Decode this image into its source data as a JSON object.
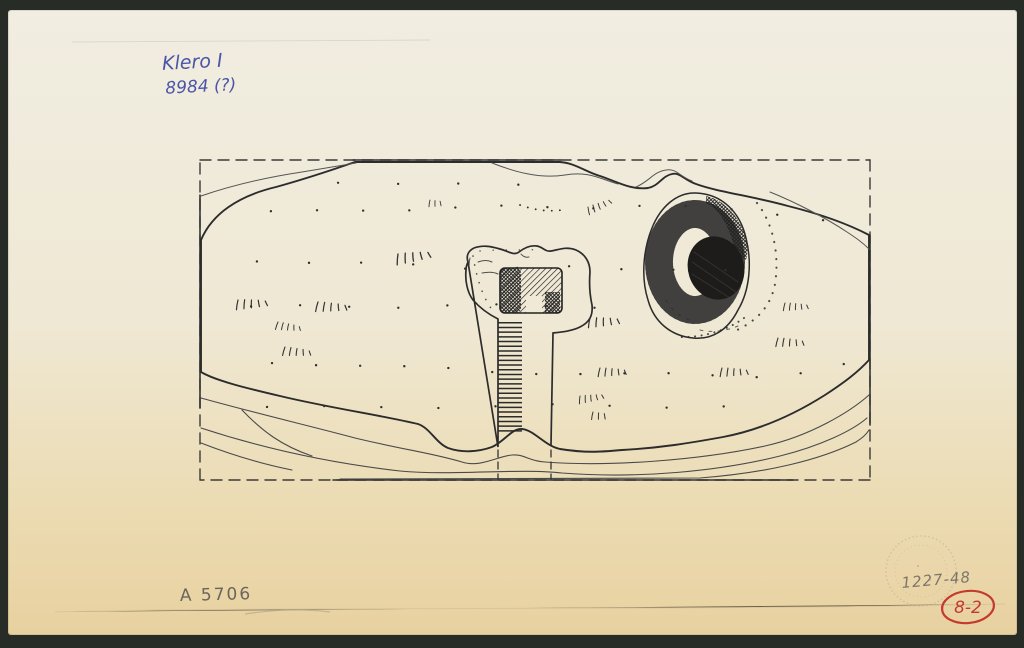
{
  "annotations": {
    "top_left_blue": {
      "line1": "Klero I",
      "line2": "8984 (?)",
      "color": "#4a55a8"
    },
    "bottom_left_pencil": {
      "text": "A 5706",
      "color": "#6b655b"
    },
    "stamp_pencil": {
      "text": "1227-48",
      "color": "#7d7568"
    },
    "red_mark": {
      "text": "8-2",
      "color": "#c53a2e"
    }
  },
  "colors": {
    "background": "#282c26",
    "paper_top": "#f1ede1",
    "paper_bottom": "#e8d1a0",
    "ink": "#2c2c2c",
    "pencil": "#7d7568",
    "stamp": "#a08fa0",
    "red": "#c53a2e"
  }
}
